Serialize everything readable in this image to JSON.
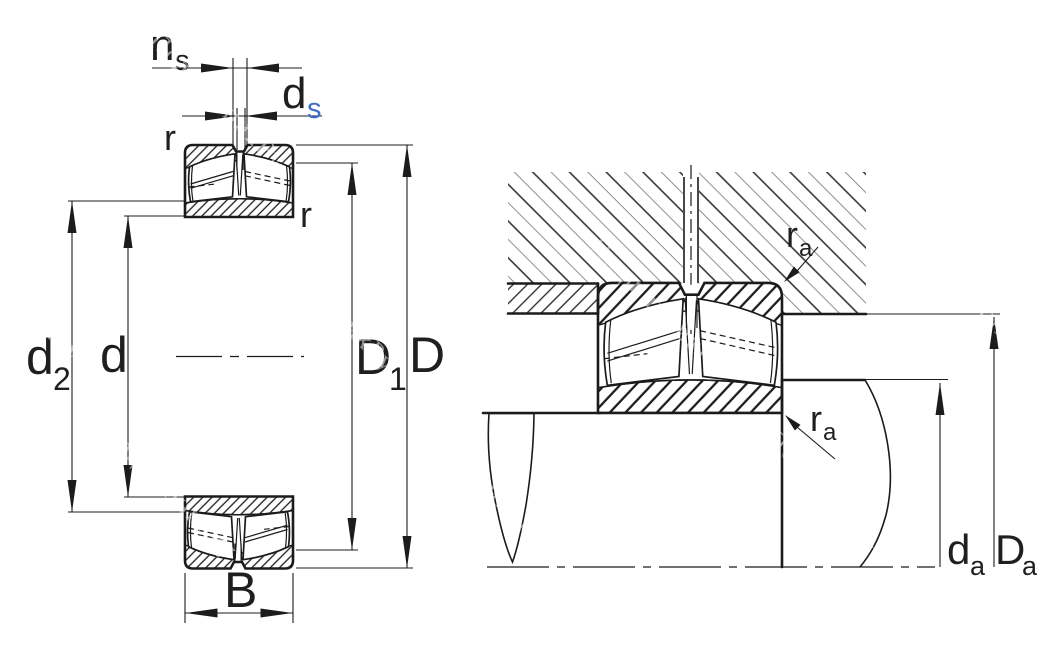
{
  "title": "Spherical roller bearing dimension drawing",
  "watermark": {
    "text": "ПодшипникРу",
    "color": "#b2b2b2"
  },
  "colors": {
    "line": "#1b1b1b",
    "subscript_blue": "#3f6cc8",
    "background": "#ffffff",
    "watermark_gray": "#b2b2b2"
  },
  "labels": {
    "ns": {
      "main": "n",
      "sub": "s"
    },
    "ds": {
      "main": "d",
      "sub": "s"
    },
    "r_outer": "r",
    "r_inner": "r",
    "d2": {
      "main": "d",
      "sub": "2"
    },
    "d": "d",
    "D1": {
      "main": "D",
      "sub": "1"
    },
    "D": "D",
    "B": "B",
    "ra_housing": {
      "main": "r",
      "sub": "a"
    },
    "ra_shaft": {
      "main": "r",
      "sub": "a"
    },
    "da": {
      "main": "d",
      "sub": "a"
    },
    "Da": {
      "main": "D",
      "sub": "a"
    }
  }
}
